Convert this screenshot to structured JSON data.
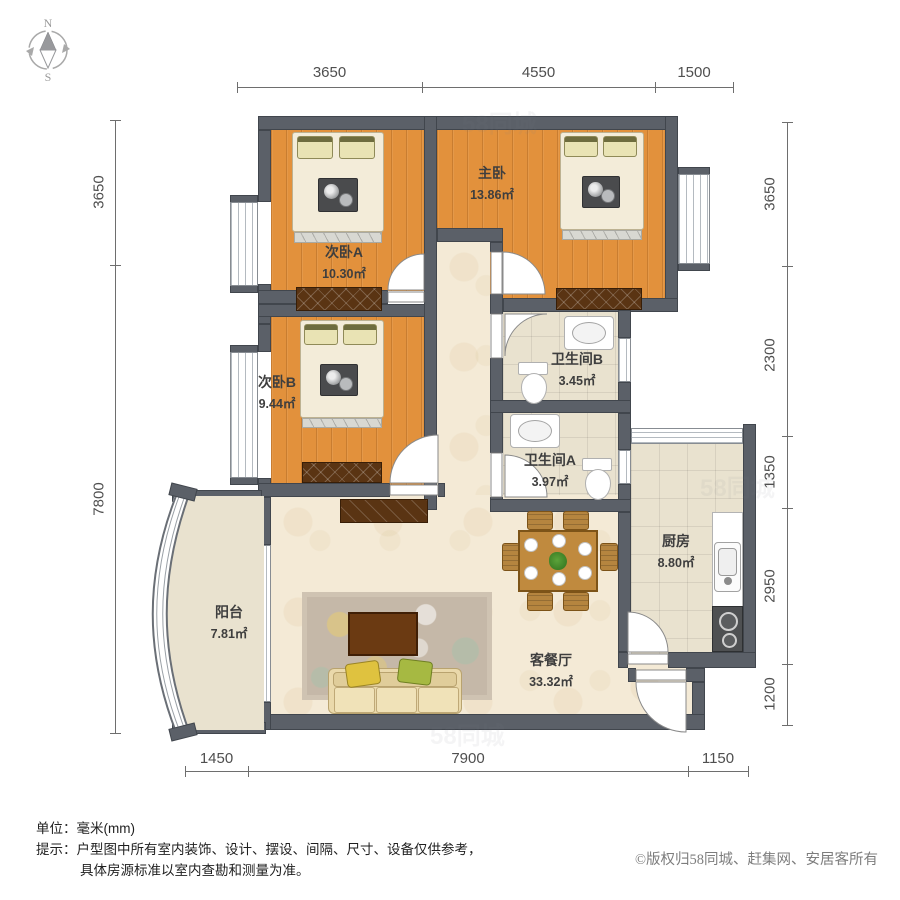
{
  "compass": {
    "north": "N",
    "south": "S"
  },
  "watermark": {
    "text": "58同城"
  },
  "dimensions": {
    "top": [
      "3650",
      "4550",
      "1500"
    ],
    "left": [
      "3650",
      "7800"
    ],
    "right": [
      "3650",
      "2300",
      "1350",
      "2950",
      "1200"
    ],
    "bottom": [
      "1450",
      "7900",
      "1150"
    ]
  },
  "rooms": [
    {
      "name": "主卧",
      "area": "13.86㎡"
    },
    {
      "name": "次卧A",
      "area": "10.30㎡"
    },
    {
      "name": "次卧B",
      "area": "9.44㎡"
    },
    {
      "name": "卫生间B",
      "area": "3.45㎡"
    },
    {
      "name": "卫生间A",
      "area": "3.97㎡"
    },
    {
      "name": "厨房",
      "area": "8.80㎡"
    },
    {
      "name": "阳台",
      "area": "7.81㎡"
    },
    {
      "name": "客餐厅",
      "area": "33.32㎡"
    }
  ],
  "footer": {
    "unit_label": "单位：",
    "unit_value": "毫米(mm)",
    "tip_label": "提示：",
    "tip_line1": "户型图中所有室内装饰、设计、摆设、间隔、尺寸、设备仅供参考，",
    "tip_line2": "具体房源标准以室内查勘和测量为准。",
    "copyright": "©版权归58同城、赶集网、安居客所有"
  },
  "colors": {
    "wall": "#5b6068",
    "wood_floor": "#e2913c",
    "tile_floor": "#e9e2cf",
    "living_floor": "#f4ead6"
  }
}
